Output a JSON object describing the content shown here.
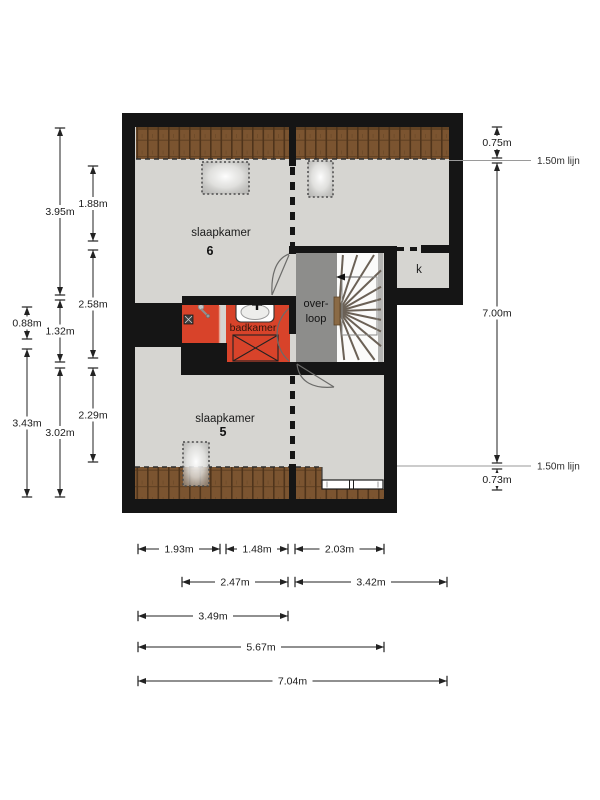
{
  "rooms": {
    "bedroom6": {
      "name": "slaapkamer",
      "number": "6"
    },
    "bedroom5": {
      "name": "slaapkamer",
      "number": "5"
    },
    "bathroom": {
      "name": "badkamer"
    },
    "landing": {
      "line1": "over-",
      "line2": "loop"
    },
    "closet": {
      "name": "k"
    }
  },
  "reference_lines": [
    {
      "label": "1.50m lijn",
      "y": 160.5,
      "x1": 449,
      "x2": 531
    },
    {
      "label": "1.50m lijn",
      "y": 466,
      "x1": 397,
      "x2": 531
    }
  ],
  "dimensions": [
    {
      "label": "3.95m",
      "axis": "v",
      "pos": 60,
      "from": 128,
      "to": 295
    },
    {
      "label": "1.32m",
      "axis": "v",
      "pos": 60,
      "from": 300,
      "to": 362
    },
    {
      "label": "3.02m",
      "axis": "v",
      "pos": 60,
      "from": 368,
      "to": 497
    },
    {
      "label": "1.88m",
      "axis": "v",
      "pos": 93,
      "from": 166,
      "to": 241
    },
    {
      "label": "2.58m",
      "axis": "v",
      "pos": 93,
      "from": 250,
      "to": 358
    },
    {
      "label": "2.29m",
      "axis": "v",
      "pos": 93,
      "from": 368,
      "to": 462
    },
    {
      "label": "0.88m",
      "axis": "v",
      "pos": 27,
      "from": 307,
      "to": 339
    },
    {
      "label": "3.43m",
      "axis": "v",
      "pos": 27,
      "from": 349,
      "to": 497
    },
    {
      "label": "0.75m",
      "axis": "v",
      "pos": 497,
      "from": 127,
      "to": 158
    },
    {
      "label": "7.00m",
      "axis": "v",
      "pos": 497,
      "from": 163,
      "to": 463
    },
    {
      "label": "0.73m",
      "axis": "v",
      "pos": 497,
      "from": 469,
      "to": 490
    },
    {
      "label": "1.93m",
      "axis": "h",
      "pos": 549,
      "from": 138,
      "to": 220
    },
    {
      "label": "1.48m",
      "axis": "h",
      "pos": 549,
      "from": 226,
      "to": 288
    },
    {
      "label": "2.03m",
      "axis": "h",
      "pos": 549,
      "from": 295,
      "to": 384
    },
    {
      "label": "2.47m",
      "axis": "h",
      "pos": 582,
      "from": 182,
      "to": 288
    },
    {
      "label": "3.42m",
      "axis": "h",
      "pos": 582,
      "from": 295,
      "to": 447
    },
    {
      "label": "3.49m",
      "axis": "h",
      "pos": 616,
      "from": 138,
      "to": 288
    },
    {
      "label": "5.67m",
      "axis": "h",
      "pos": 647,
      "from": 138,
      "to": 384
    },
    {
      "label": "7.04m",
      "axis": "h",
      "pos": 681,
      "from": 138,
      "to": 447
    }
  ],
  "colors": {
    "wall": "#151515",
    "floor": "#d6d5d1",
    "roof": "#7b5430",
    "roof_dark": "#4f341b",
    "bathroom": "#d8432a",
    "landing": "#8d8d8b",
    "stairs": "#fbfbfa",
    "stairs_edge": "#b4b4b2",
    "tread": "#6b6156",
    "dim": "#222222",
    "ref": "#9a9a9a"
  }
}
